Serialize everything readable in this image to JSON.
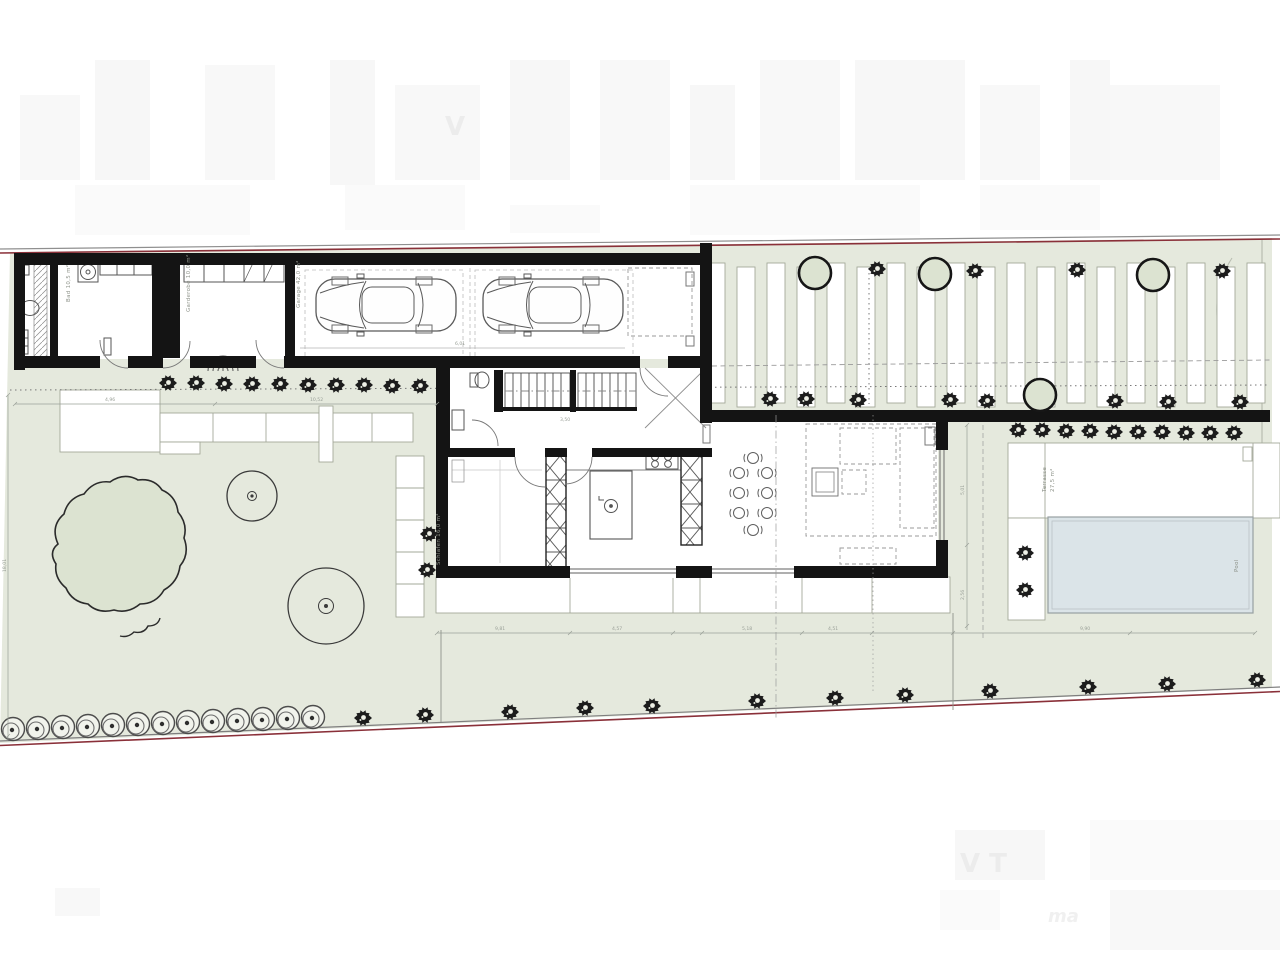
{
  "title": "Erdgeschoss Lageplan / ground-floor site plan",
  "palette": {
    "site_green": "#e5e9dd",
    "tree_green": "#dce3d1",
    "pool_blue": "#dbe4e8",
    "wall_black": "#141414",
    "boundary_red": "#8a3039",
    "line_gray": "#9aa098"
  },
  "labels": {
    "bad": "Bad 10,5 m²",
    "garderobe": "Garderobe 10,0 m²",
    "garage": "Garage 42,0 m²",
    "schlafen": "Schlafen 16,0 m²",
    "terrasse": "Terrasse",
    "terrasse_area": "27,5 m²",
    "pool": "Pool"
  },
  "dims": {
    "walk1": "4,96",
    "walk2": "10,52",
    "garage_w": "6,01",
    "stairs": "3,50",
    "t1": "9,81",
    "t2": "4,57",
    "t3": "5,18",
    "t4": "4,51",
    "t5": "9,90",
    "v1": "5,01",
    "v2": "2,56",
    "left_v": "18,01"
  },
  "watermark": {
    "w1": "V",
    "w2": "V T",
    "w3": "ma"
  },
  "plants": {
    "walkway_bushes": [
      [
        168,
        383
      ],
      [
        196,
        383
      ],
      [
        224,
        384
      ],
      [
        252,
        384
      ],
      [
        280,
        384
      ],
      [
        308,
        385
      ],
      [
        336,
        385
      ],
      [
        364,
        385
      ],
      [
        392,
        386
      ],
      [
        420,
        386
      ]
    ],
    "drive_top_stars": [
      [
        877,
        269
      ],
      [
        975,
        271
      ],
      [
        1077,
        270
      ],
      [
        1222,
        271
      ]
    ],
    "drive_top_trees": [
      [
        815,
        273
      ],
      [
        935,
        274
      ],
      [
        1153,
        275
      ]
    ],
    "drive_bottom_stars": [
      [
        770,
        399
      ],
      [
        806,
        399
      ],
      [
        858,
        400
      ],
      [
        950,
        400
      ],
      [
        987,
        401
      ],
      [
        1115,
        401
      ],
      [
        1168,
        402
      ],
      [
        1240,
        402
      ]
    ],
    "drive_bottom_trees": [
      [
        1040,
        395
      ]
    ],
    "hedge_stars": [
      [
        1018,
        430
      ],
      [
        1042,
        430
      ],
      [
        1066,
        431
      ],
      [
        1090,
        431
      ],
      [
        1114,
        432
      ],
      [
        1138,
        432
      ],
      [
        1162,
        432
      ],
      [
        1186,
        433
      ],
      [
        1210,
        433
      ],
      [
        1234,
        433
      ]
    ],
    "pool_side_stars": [
      [
        1025,
        553
      ],
      [
        1025,
        590
      ]
    ],
    "path_side_stars": [
      [
        429,
        534
      ],
      [
        427,
        570
      ]
    ],
    "bottom_circle_bushes": [
      [
        13,
        729
      ],
      [
        38,
        728
      ],
      [
        63,
        727
      ],
      [
        88,
        726
      ],
      [
        113,
        725
      ],
      [
        138,
        724
      ],
      [
        163,
        723
      ],
      [
        188,
        722
      ],
      [
        213,
        721
      ],
      [
        238,
        720
      ],
      [
        263,
        719
      ],
      [
        288,
        718
      ],
      [
        313,
        717
      ]
    ],
    "bottom_stars": [
      [
        363,
        718
      ],
      [
        425,
        715
      ],
      [
        510,
        712
      ],
      [
        585,
        708
      ],
      [
        652,
        706
      ],
      [
        757,
        701
      ],
      [
        835,
        698
      ],
      [
        905,
        695
      ],
      [
        990,
        691
      ],
      [
        1088,
        687
      ],
      [
        1167,
        684
      ],
      [
        1257,
        680
      ]
    ]
  },
  "pavers": {
    "strips": [
      [
        716,
        263
      ],
      [
        746,
        267
      ],
      [
        776,
        263
      ],
      [
        806,
        267
      ],
      [
        836,
        263
      ],
      [
        866,
        267
      ],
      [
        896,
        263
      ],
      [
        926,
        267
      ],
      [
        956,
        263
      ],
      [
        986,
        267
      ],
      [
        1016,
        263
      ],
      [
        1046,
        267
      ],
      [
        1076,
        263
      ],
      [
        1106,
        267
      ],
      [
        1136,
        263
      ],
      [
        1166,
        267
      ],
      [
        1196,
        263
      ],
      [
        1226,
        267
      ],
      [
        1256,
        263
      ]
    ]
  },
  "dining_chairs": [
    [
      739,
      473
    ],
    [
      739,
      493
    ],
    [
      739,
      513
    ],
    [
      767,
      473
    ],
    [
      767,
      493
    ],
    [
      767,
      513
    ],
    [
      753,
      458
    ],
    [
      753,
      530
    ]
  ]
}
